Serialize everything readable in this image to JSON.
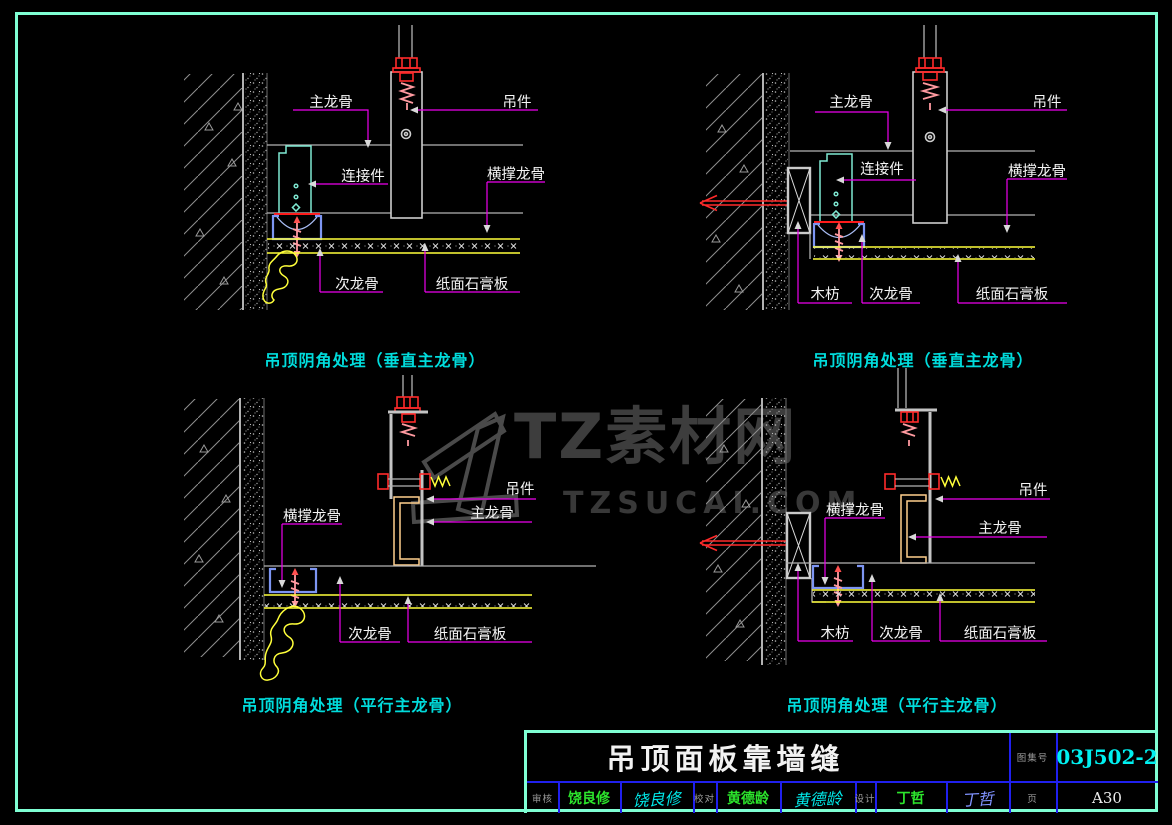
{
  "watermark": {
    "title": "TZ素材网",
    "subtitle": "TZSUCAI.COM"
  },
  "panels": {
    "top_left": {
      "caption": "吊顶阴角处理（垂直主龙骨）",
      "labels": {
        "main_keel": "主龙骨",
        "hanger": "吊件",
        "connector": "连接件",
        "cross_brace_keel": "横撑龙骨",
        "secondary_keel": "次龙骨",
        "gypsum_board": "纸面石膏板"
      }
    },
    "top_right": {
      "caption": "吊顶阴角处理（垂直主龙骨）",
      "labels": {
        "main_keel": "主龙骨",
        "hanger": "吊件",
        "connector": "连接件",
        "cross_brace_keel": "横撑龙骨",
        "wood_block": "木枋",
        "secondary_keel": "次龙骨",
        "gypsum_board": "纸面石膏板"
      }
    },
    "bottom_left": {
      "caption": "吊顶阴角处理（平行主龙骨）",
      "labels": {
        "cross_brace_keel": "横撑龙骨",
        "hanger": "吊件",
        "main_keel": "主龙骨",
        "secondary_keel": "次龙骨",
        "gypsum_board": "纸面石膏板"
      }
    },
    "bottom_right": {
      "caption": "吊顶阴角处理（平行主龙骨）",
      "labels": {
        "cross_brace_keel": "横撑龙骨",
        "hanger": "吊件",
        "main_keel": "主龙骨",
        "wood_block": "木枋",
        "secondary_keel": "次龙骨",
        "gypsum_board": "纸面石膏板"
      }
    }
  },
  "title_block": {
    "drawing_title": "吊顶面板靠墙缝",
    "atlas_label": "图集号",
    "atlas_number": "03J502-2",
    "page_label": "页",
    "page_number": "A30",
    "reviewer_label": "审核",
    "reviewer_name": "饶良修",
    "reviewer_signature": "饶良修",
    "proofreader_label": "校对",
    "proofreader_name": "黄德龄",
    "proofreader_signature": "黄德龄",
    "designer_label": "设计",
    "designer_name": "丁哲",
    "designer_signature": "丁哲"
  },
  "colors": {
    "page_border": "#7fffd4",
    "caption_text": "#00dcdc",
    "leader_line": "#ee00ee",
    "gypsum_line": "#ffff3a",
    "edge_channel": "#7d95f2",
    "main_keel_outline": "#7fe9d2",
    "fastener_red": "#ff2a2a",
    "atlas_number_text": "#00f0f0",
    "name_text": "#2ce52c"
  }
}
